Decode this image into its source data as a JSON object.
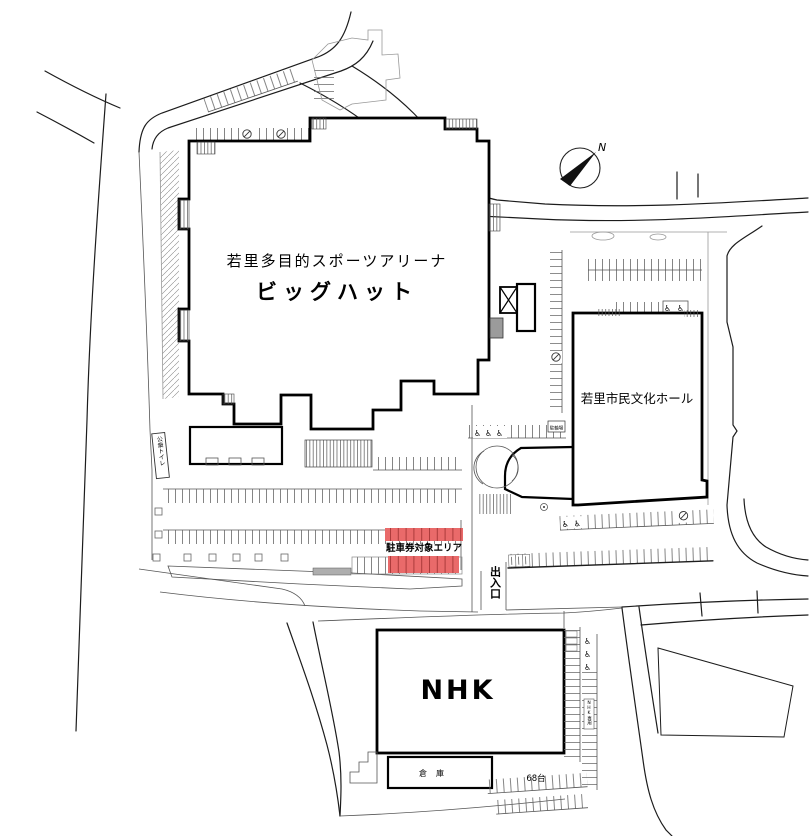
{
  "map": {
    "arena": {
      "name_line1": "若里多目的スポーツアリーナ",
      "name_line2": "ビッグハット"
    },
    "buildings": {
      "culture_hall": "若里市民文化ホール",
      "nhk": "NHK",
      "warehouse": "倉庫"
    },
    "labels": {
      "parking_ticket_area": "駐車券対象エリア",
      "gate": "出入口",
      "public_toilet": "公衆トイレ",
      "bicycle_parking": "駐輪場",
      "capacity": "68台",
      "nhk_reserved": "NHK専用",
      "compass_north": "N"
    },
    "icons": {
      "wheelchair": "♿"
    },
    "colors": {
      "highlight_red": "#e96a6a",
      "line": "#1a1a1a"
    }
  }
}
